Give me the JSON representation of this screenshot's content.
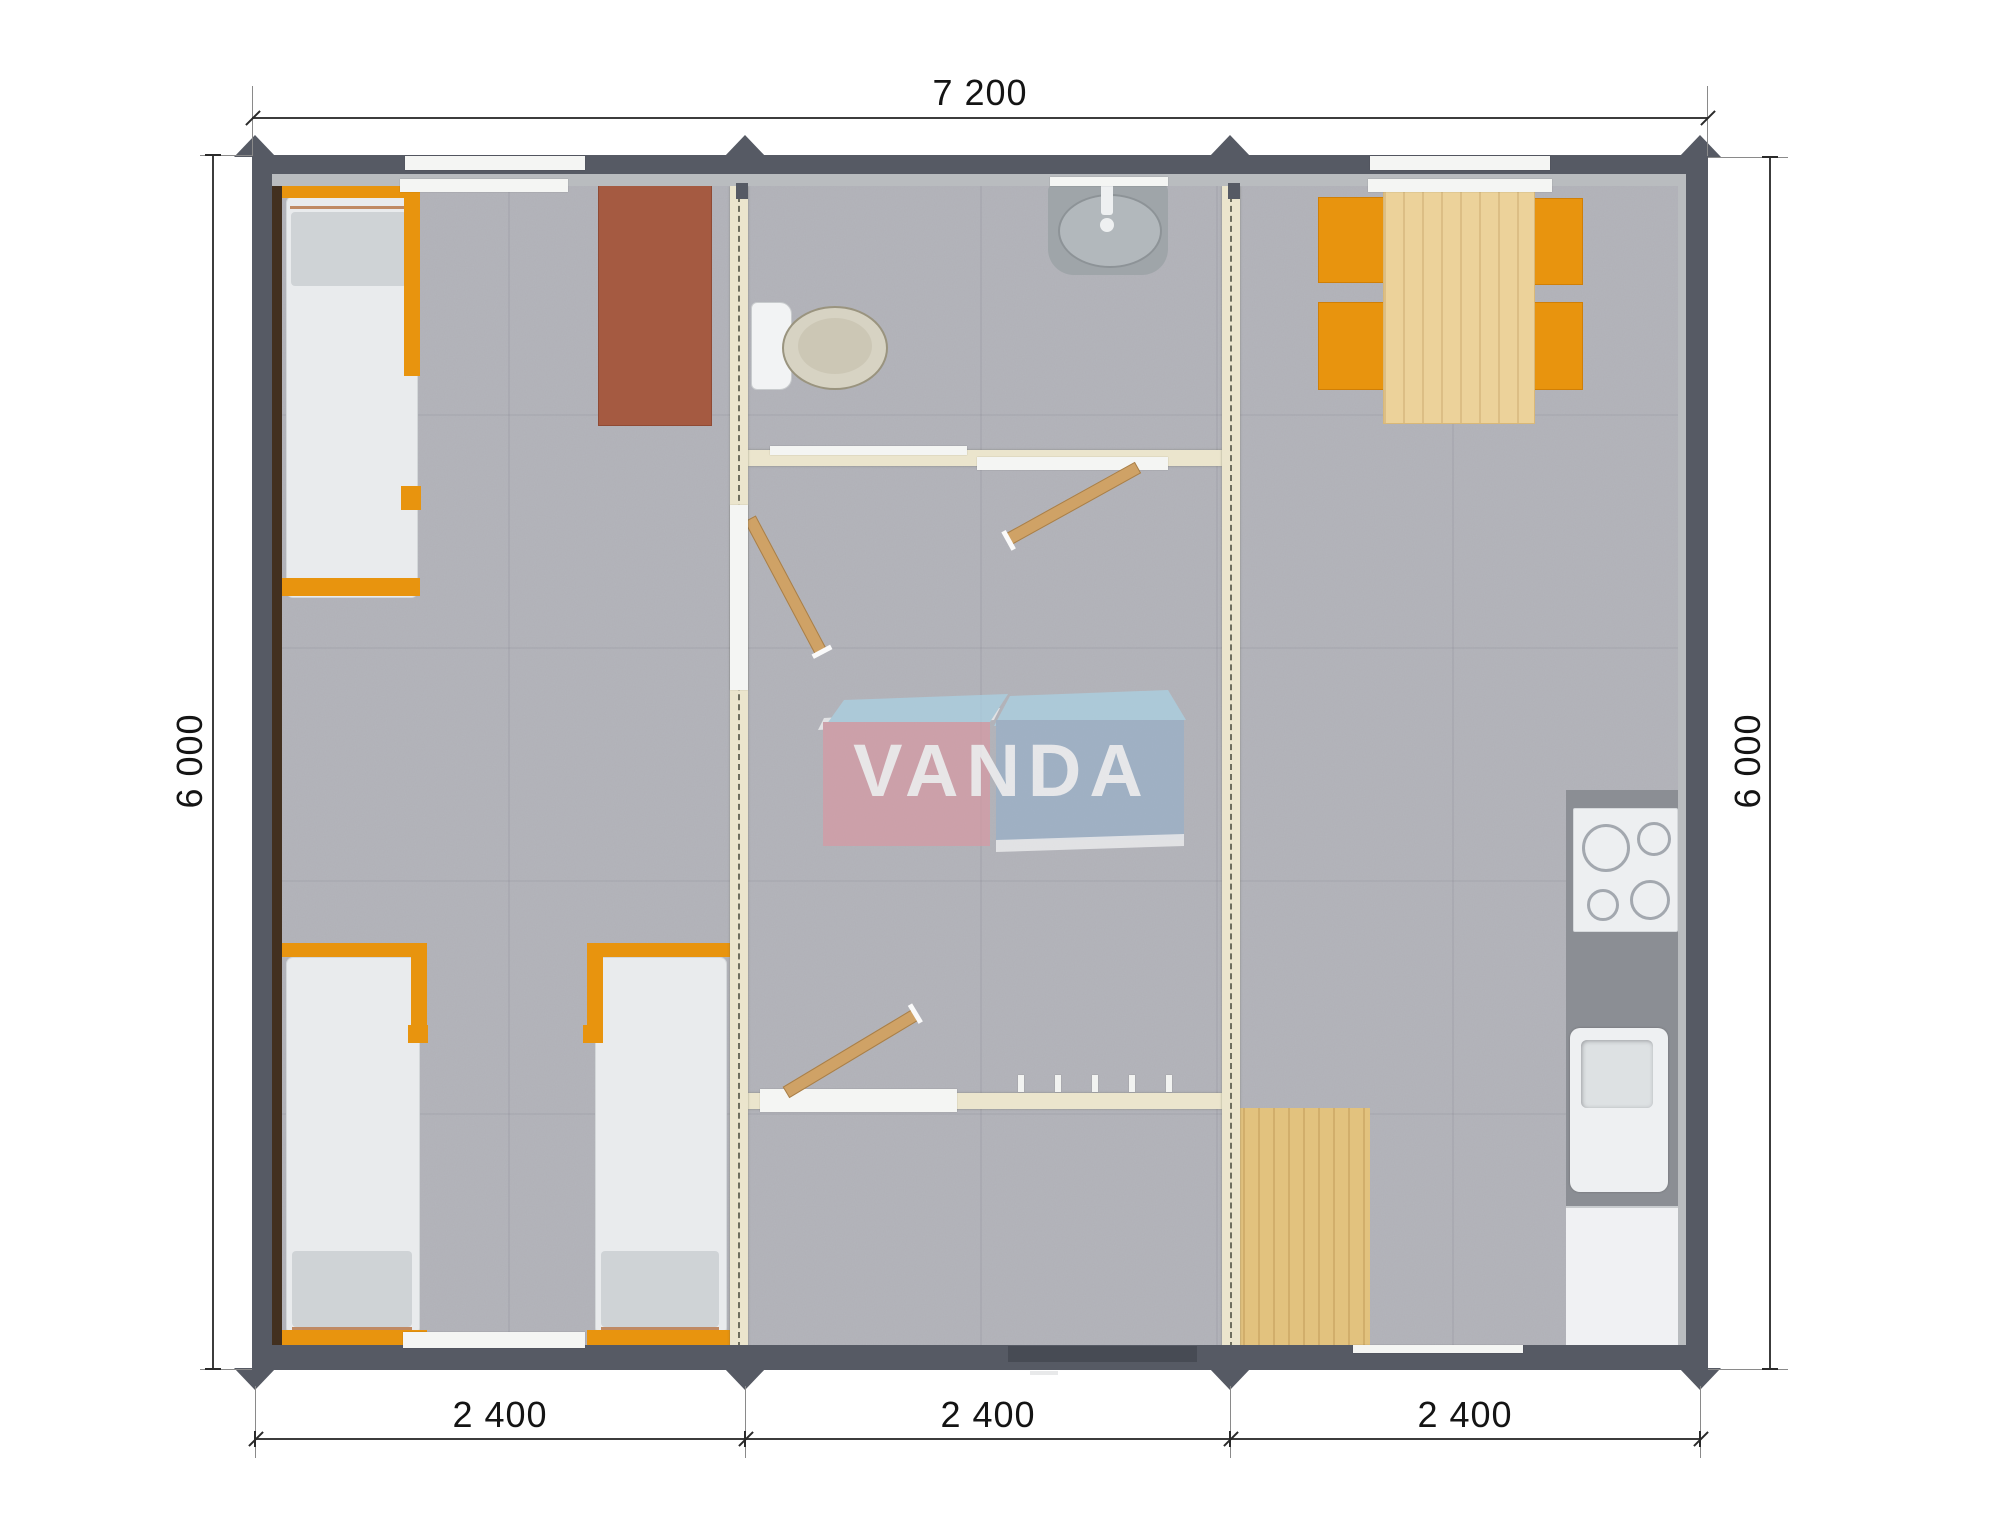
{
  "title": "VANDA modular building floor plan",
  "brand": {
    "logo_text": "VANDA"
  },
  "dimensions": {
    "overall_width": "7 200",
    "overall_depth_left": "6 000",
    "overall_depth_right": "6 000",
    "modules": [
      "2 400",
      "2 400",
      "2 400"
    ]
  },
  "furniture": [
    "single-bed",
    "single-bed",
    "single-bed",
    "wardrobe",
    "toilet",
    "washbasin",
    "interior-door",
    "interior-door",
    "interior-door",
    "coat-hooks",
    "entrance-door",
    "dining-table",
    "chair",
    "chair",
    "chair",
    "chair",
    "cooktop",
    "kitchen-sink",
    "kitchen-counter",
    "kitchen-cabinet",
    "floor-mat"
  ],
  "colors": {
    "wall": "#565a64",
    "wall_inner_band": "#b9bcbf",
    "floor": "#b4b5bb",
    "partition": "#ebe5cd",
    "accent_orange": "#e8940e",
    "wood_light": "#ecd29a",
    "wood_mat": "#e2c27e",
    "wardrobe_brown": "#a55a41",
    "wall_lining_brown": "#42301f",
    "counter_gray": "#8b8e94",
    "fixture_white": "#f2f3f4",
    "logo_pink": "#d69aa4",
    "logo_blue": "#99b0c8",
    "logo_light_blue": "#abd2e4"
  }
}
